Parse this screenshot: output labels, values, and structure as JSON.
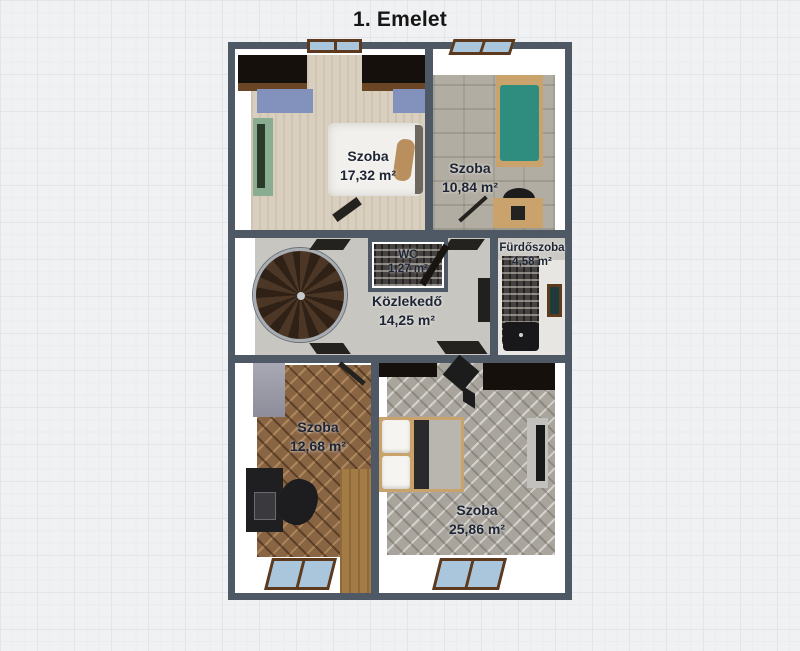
{
  "title": "1. Emelet",
  "rooms": [
    {
      "id": "szoba-1",
      "name": "Szoba",
      "area": "17,32 m²"
    },
    {
      "id": "szoba-2",
      "name": "Szoba",
      "area": "10,84 m²"
    },
    {
      "id": "wc",
      "name": "WC",
      "area": "1,27 m²"
    },
    {
      "id": "furdoszoba",
      "name": "Fürdőszoba",
      "area": "4,58 m²"
    },
    {
      "id": "kozlekedo",
      "name": "Közlekedő",
      "area": "14,25 m²"
    },
    {
      "id": "szoba-3",
      "name": "Szoba",
      "area": "12,68 m²"
    },
    {
      "id": "szoba-4",
      "name": "Szoba",
      "area": "25,86 m²"
    }
  ],
  "furniture": [
    "double-bed",
    "single-bed",
    "wardrobe",
    "green-wardrobe",
    "spiral-staircase",
    "desk",
    "office-chair",
    "bathtub",
    "mirror",
    "window",
    "door-leaf",
    "tv-unit"
  ],
  "colors": {
    "wall": "#4e5965",
    "background": "#f0f1f3",
    "floor_beige": "#d9cfbf",
    "floor_stone": "#b2ada2",
    "floor_hall": "#c8c6c1",
    "floor_wood_brown": "#8a6544",
    "floor_wood_gray": "#a9a59d",
    "teal_bed": "#2f8d80",
    "green_wardrobe": "#8aad92",
    "blue_bedding": "#8391bd",
    "window_glass": "#a9c6dd",
    "window_frame": "#5d3a1d",
    "label_text": "#1d2433"
  }
}
